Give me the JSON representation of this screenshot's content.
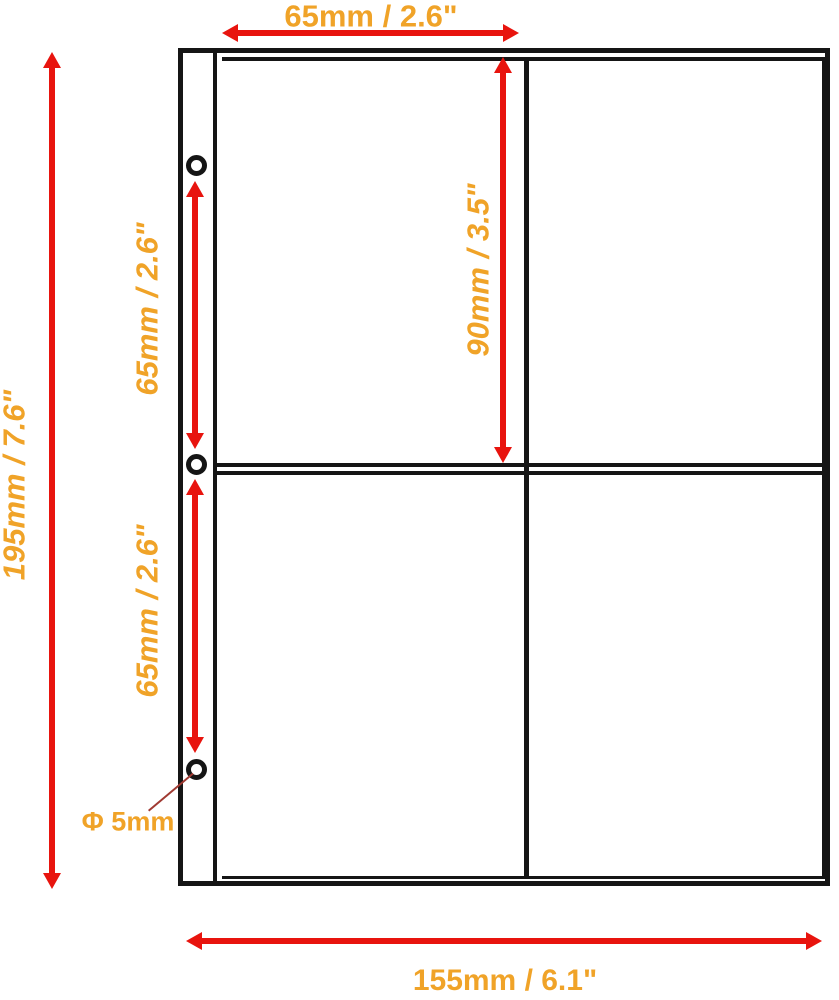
{
  "title": "Binder pocket page dimension diagram",
  "colors": {
    "background": "#ffffff",
    "outline": "#151515",
    "arrow": "#e8140e",
    "text": "#f0a328",
    "leader": "#a03a32"
  },
  "labels": {
    "pocket_width_top": "65mm / 2.6\"",
    "page_height_left": "195mm / 7.6\"",
    "hole_spacing_upper": "65mm / 2.6\"",
    "hole_spacing_lower": "65mm / 2.6\"",
    "pocket_height": "90mm / 3.5\"",
    "page_width_bottom": "155mm / 6.1\"",
    "hole_diameter": "Φ 5mm"
  },
  "figure": {
    "holes_count": 3,
    "pockets_grid": "2x2"
  }
}
